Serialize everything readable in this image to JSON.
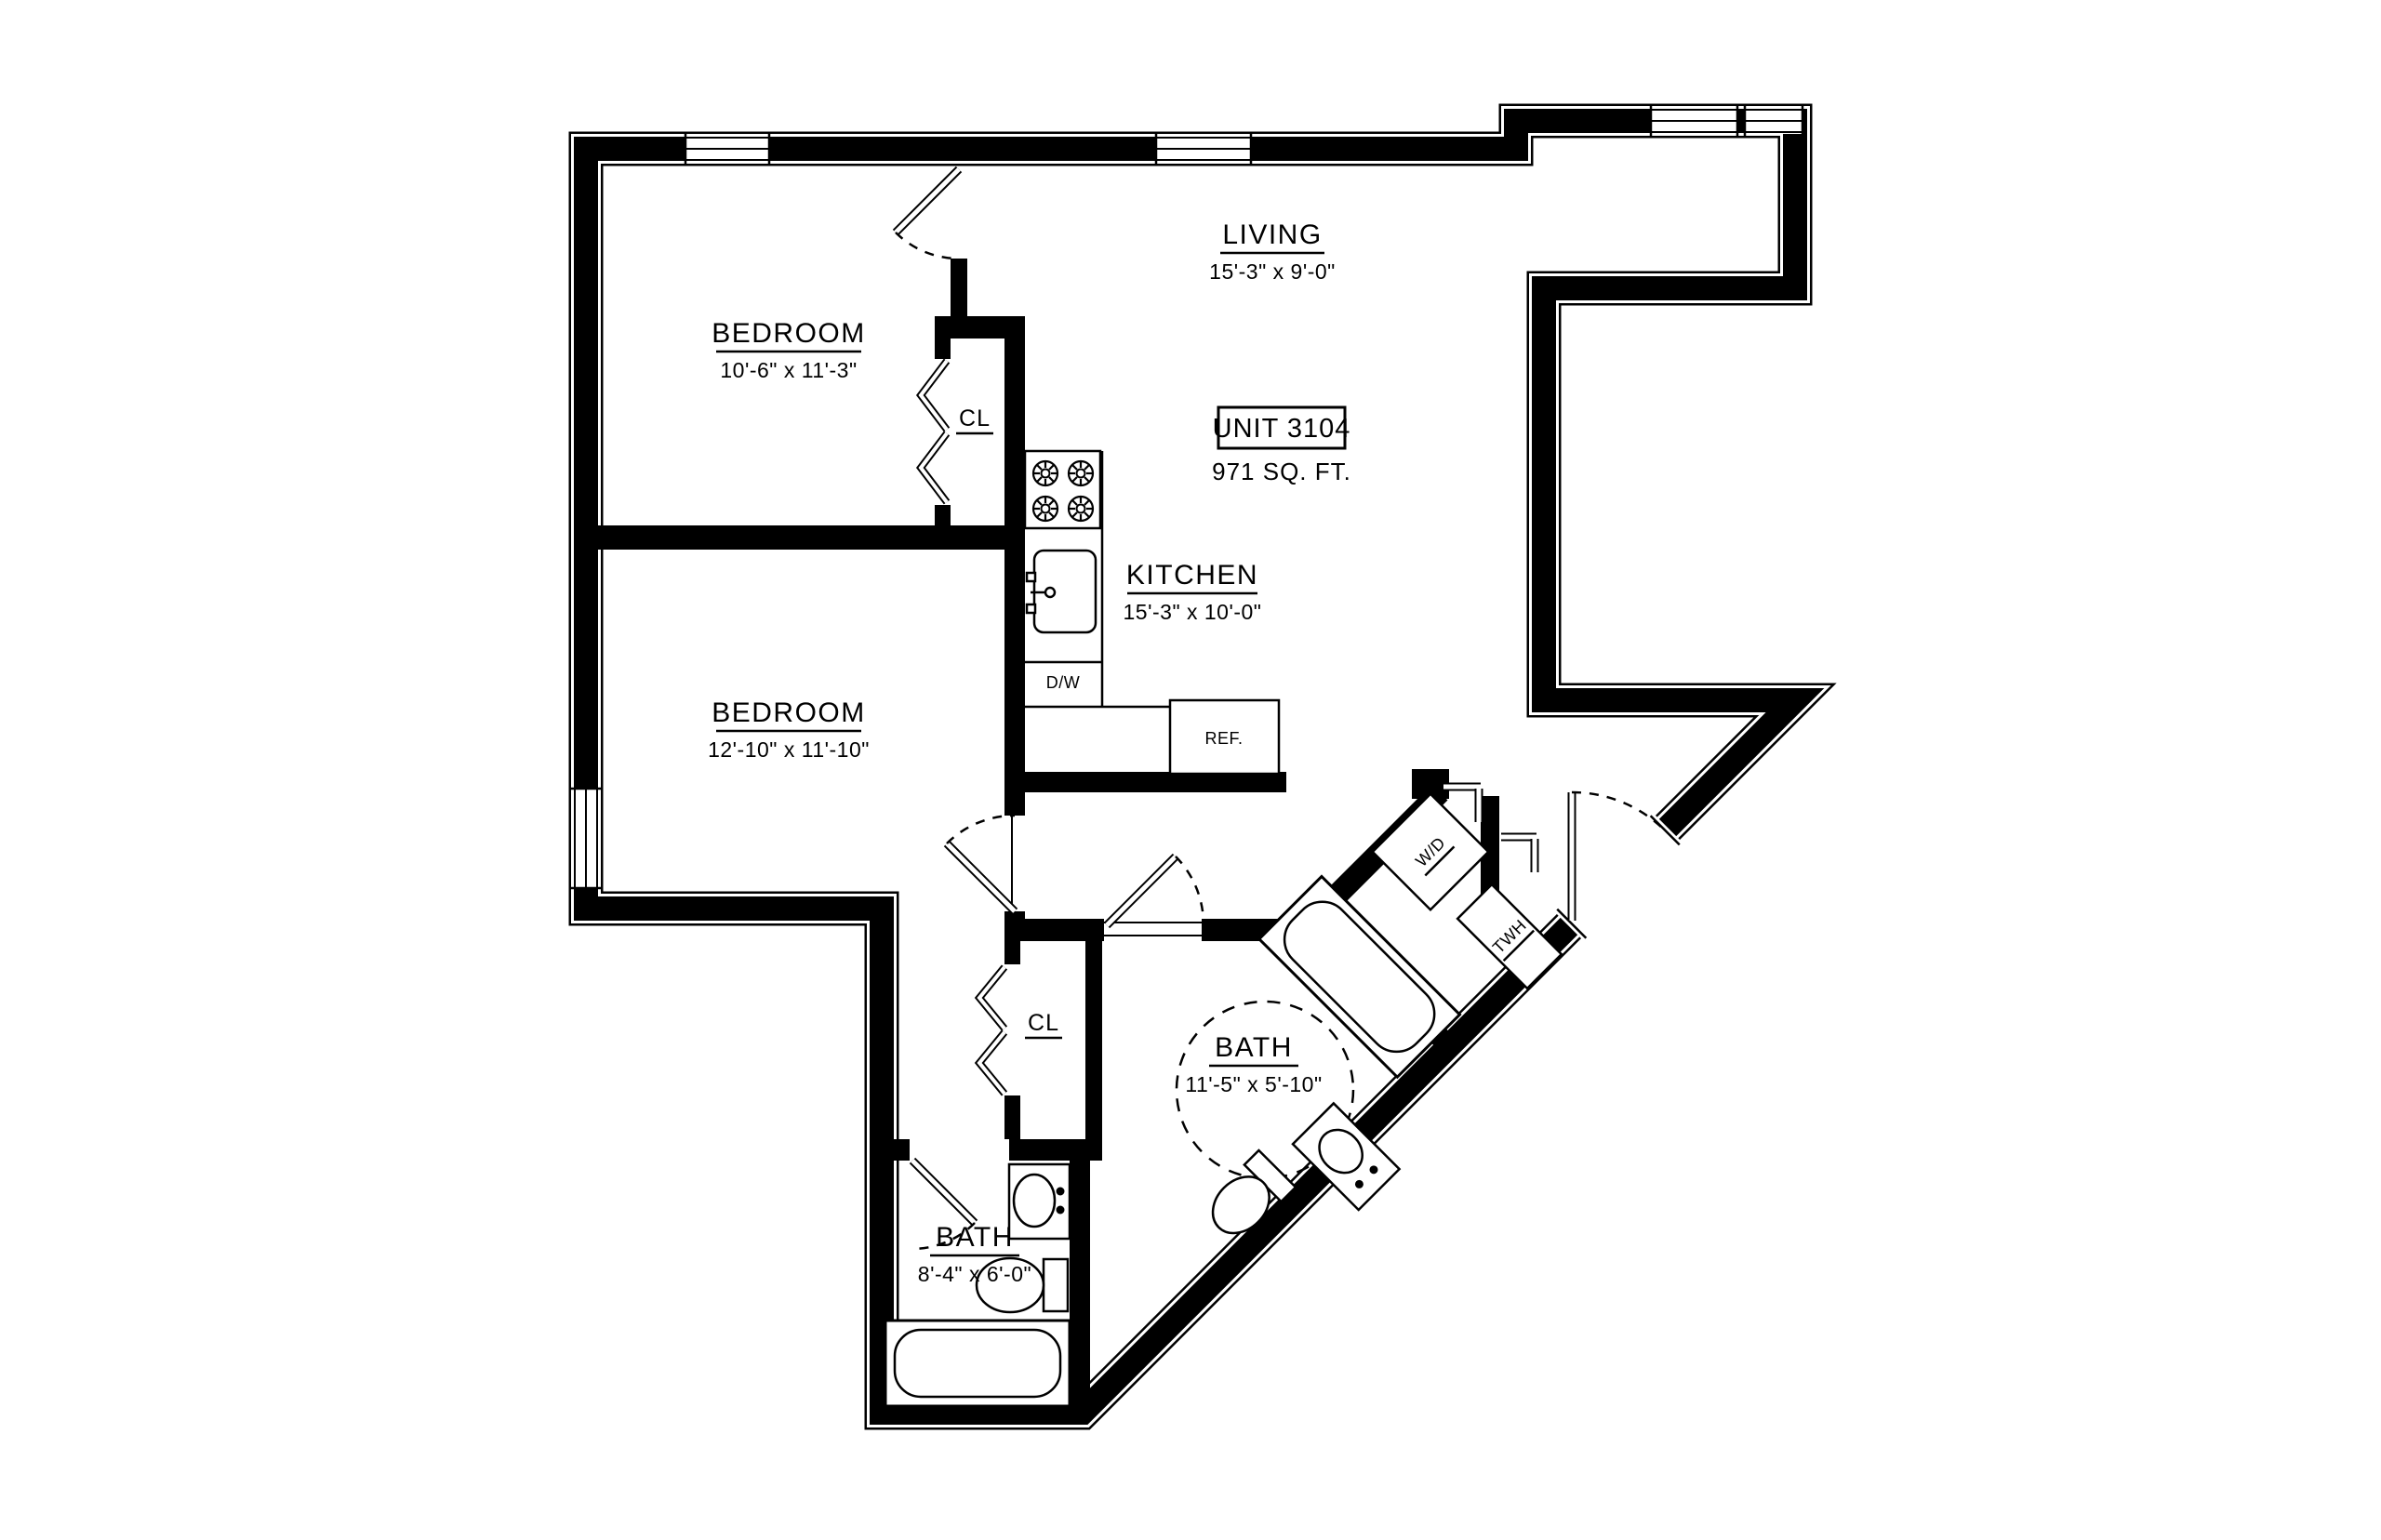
{
  "plan": {
    "unit": {
      "label": "UNIT 3104",
      "area": "971 SQ. FT."
    },
    "rooms": {
      "living": {
        "name": "LIVING",
        "dims": "15'-3\" x 9'-0\""
      },
      "bedroom1": {
        "name": "BEDROOM",
        "dims": "10'-6\" x 11'-3\""
      },
      "bedroom2": {
        "name": "BEDROOM",
        "dims": "12'-10\" x 11'-10\""
      },
      "kitchen": {
        "name": "KITCHEN",
        "dims": "15'-3\" x 10'-0\""
      },
      "bath1": {
        "name": "BATH",
        "dims": "11'-5\" x 5'-10\""
      },
      "bath2": {
        "name": "BATH",
        "dims": "8'-4\" x 6'-0\""
      },
      "closet1": {
        "name": "CL"
      },
      "closet2": {
        "name": "CL"
      }
    },
    "appliances": {
      "dishwasher": "D/W",
      "refrigerator": "REF.",
      "washer_dryer": "W/D",
      "water_heater": "TWH"
    },
    "colors": {
      "wall": "#000000",
      "background": "#ffffff"
    }
  }
}
